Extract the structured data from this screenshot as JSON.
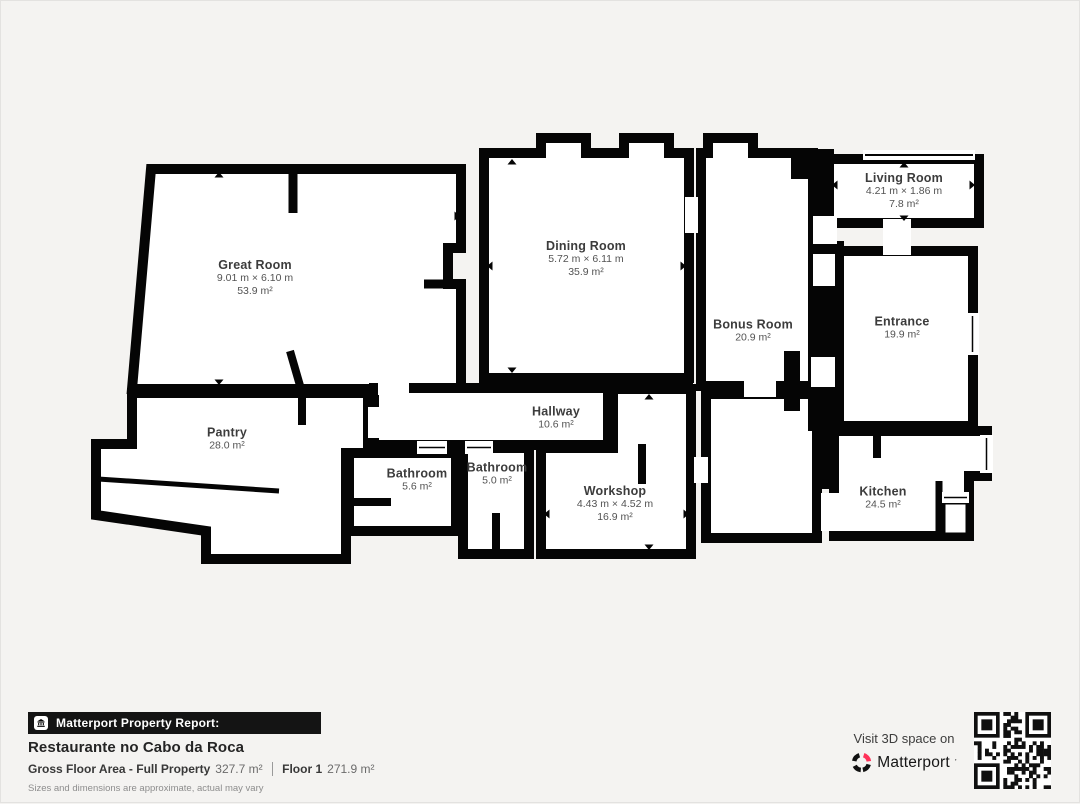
{
  "floorplan": {
    "rooms": [
      {
        "id": "great-room",
        "name": "Great Room",
        "dims": "9.01 m × 6.10 m",
        "area": "53.9 m²",
        "cx": 254,
        "cy": 277
      },
      {
        "id": "dining-room",
        "name": "Dining Room",
        "dims": "5.72 m × 6.11 m",
        "area": "35.9 m²",
        "cx": 585,
        "cy": 258
      },
      {
        "id": "bonus-room",
        "name": "Bonus Room",
        "dims": "",
        "area": "20.9 m²",
        "cx": 752,
        "cy": 330
      },
      {
        "id": "living-room",
        "name": "Living Room",
        "dims": "4.21 m × 1.86 m",
        "area": "7.8 m²",
        "cx": 903,
        "cy": 190
      },
      {
        "id": "entrance",
        "name": "Entrance",
        "dims": "",
        "area": "19.9 m²",
        "cx": 901,
        "cy": 327
      },
      {
        "id": "pantry",
        "name": "Pantry",
        "dims": "",
        "area": "28.0 m²",
        "cx": 226,
        "cy": 438
      },
      {
        "id": "hallway",
        "name": "Hallway",
        "dims": "",
        "area": "10.6 m²",
        "cx": 555,
        "cy": 417
      },
      {
        "id": "bathroom-1",
        "name": "Bathroom",
        "dims": "",
        "area": "5.6 m²",
        "cx": 416,
        "cy": 479
      },
      {
        "id": "bathroom-2",
        "name": "Bathroom",
        "dims": "",
        "area": "5.0 m²",
        "cx": 496,
        "cy": 473
      },
      {
        "id": "workshop",
        "name": "Workshop",
        "dims": "4.43 m × 4.52 m",
        "area": "16.9 m²",
        "cx": 614,
        "cy": 503
      },
      {
        "id": "kitchen",
        "name": "Kitchen",
        "dims": "",
        "area": "24.5 m²",
        "cx": 882,
        "cy": 497
      }
    ]
  },
  "footer": {
    "report_label": "Matterport Property Report:",
    "property_name": "Restaurante no Cabo da Roca",
    "gross_label": "Gross Floor Area - Full Property",
    "gross_value": "327.7 m²",
    "floor_label": "Floor 1",
    "floor_value": "271.9 m²",
    "disclaimer": "Sizes and dimensions are approximate, actual may vary"
  },
  "cta": {
    "visit_text": "Visit 3D space on",
    "brand": "Matterport",
    "brand_mark": "’"
  },
  "icons": {
    "report_bar_icon": "building-icon",
    "brand_icon": "matterport-logo-icon",
    "qr": "qr-code"
  },
  "colors": {
    "page_bg": "#f4f3f1",
    "wall": "#050505",
    "room_fill": "#ffffff",
    "bar_bg": "#141414",
    "accent_red": "#ff3158"
  }
}
